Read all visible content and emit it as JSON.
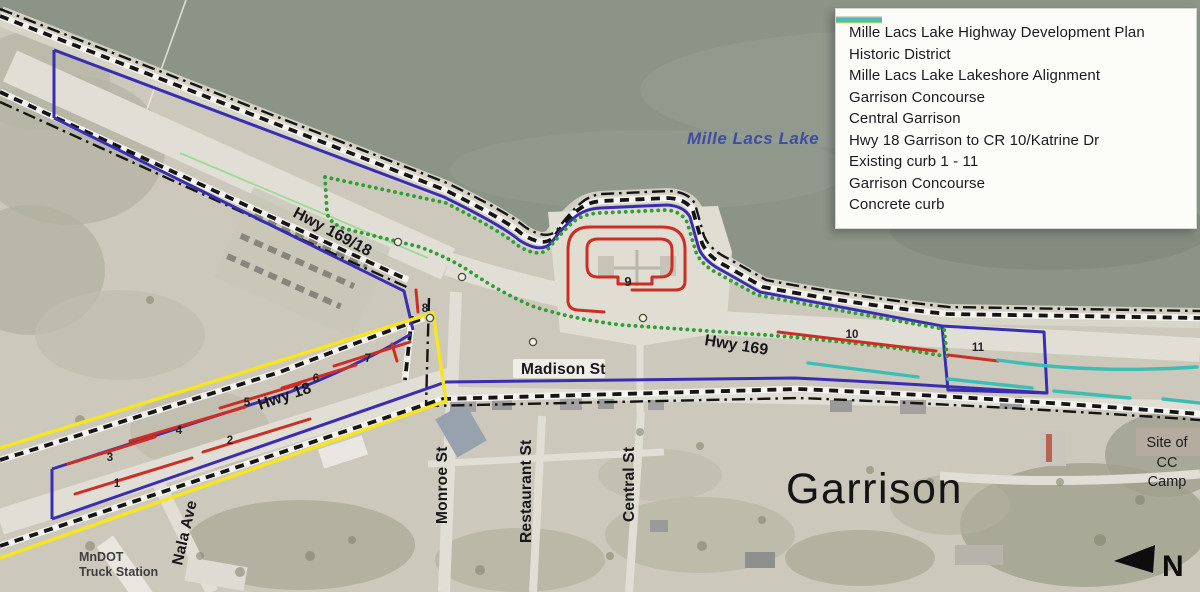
{
  "colors": {
    "historic_district": "#151515",
    "lakeshore_alignment": "#141414",
    "garrison_concourse": "#2f9e35",
    "central_garrison": "#3a2db2",
    "hwy18_garrison": "#f7e51d",
    "existing_curb": "#cd2e24",
    "concrete_curb": "#3fbdb4",
    "lake": "#8c9487",
    "lake_label": "#3d4da3"
  },
  "legend": {
    "items": [
      {
        "id": "historic-district",
        "label": "Mille Lacs Lake Highway Development Plan Historic District"
      },
      {
        "id": "lakeshore-alignment",
        "label": "Mille Lacs Lake Lakeshore Alignment"
      },
      {
        "id": "garrison-concourse",
        "label": "Garrison Concourse"
      },
      {
        "id": "central-garrison",
        "label": "Central Garrison"
      },
      {
        "id": "hwy18-garrison",
        "label": "Hwy 18 Garrison to CR 10/Katrine Dr"
      },
      {
        "id": "existing-curb",
        "label": "Existing curb 1 - 11"
      },
      {
        "id": "garrison-concourse-2",
        "label": "Garrison Concourse"
      },
      {
        "id": "concrete-curb",
        "label": "Concrete curb"
      }
    ]
  },
  "map": {
    "water_label": "Mille Lacs Lake",
    "town_label": "Garrison",
    "streets": {
      "hwy_169_18": "Hwy 169/18",
      "hwy_169": "Hwy 169",
      "hwy_18": "Hwy 18",
      "madison": "Madison St",
      "monroe": "Monroe St",
      "restaurant": "Restaurant St",
      "central": "Central St",
      "nala": "Nala Ave"
    },
    "places": {
      "mndot_line1": "MnDOT",
      "mndot_line2": "Truck Station",
      "cc_line1": "Site of",
      "cc_line2": "CC",
      "cc_line3": "Camp"
    },
    "curb_numbers": [
      "1",
      "2",
      "3",
      "4",
      "5",
      "6",
      "7",
      "8",
      "9",
      "10",
      "11"
    ],
    "north_label": "N"
  }
}
